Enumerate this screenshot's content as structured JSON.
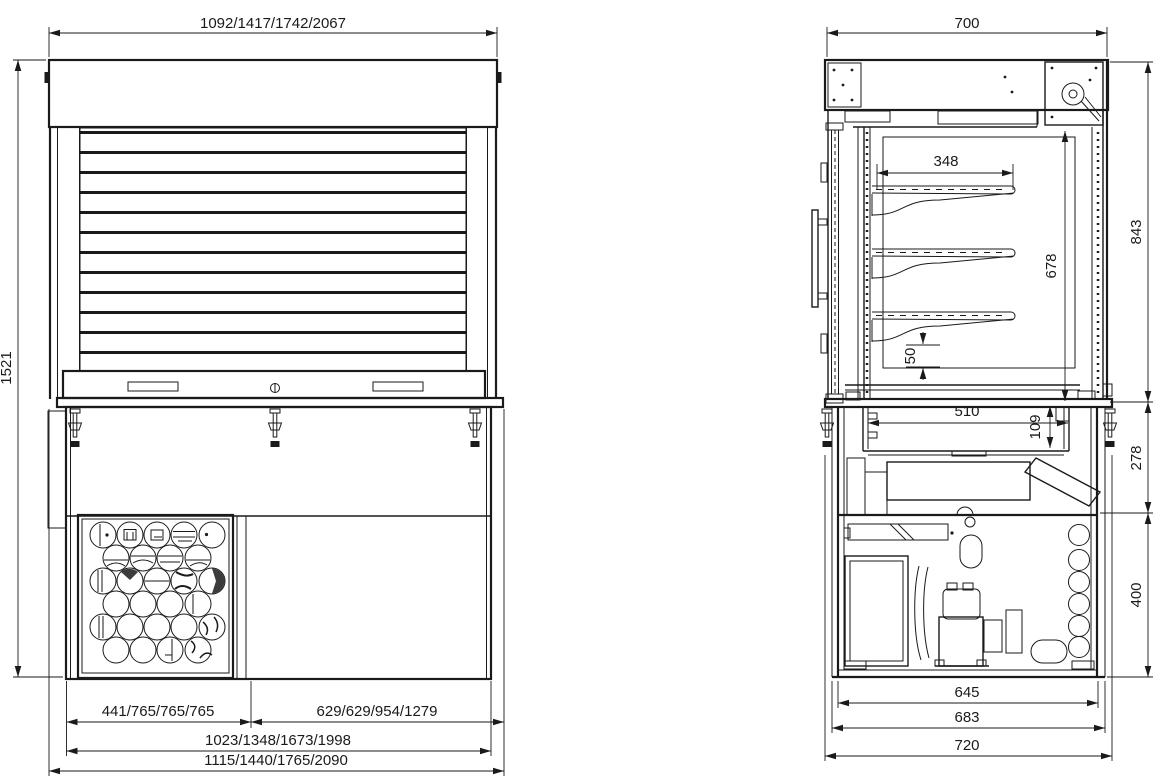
{
  "drawing_type": "technical dimension drawing, refrigerated display case with roller shutter",
  "line_color": "#1a1a1a",
  "background": "#ffffff",
  "front_view": {
    "name": "front elevation with roller shutter",
    "dims": {
      "overall_width_top": "1092/1417/1742/2067",
      "overall_height": "1521",
      "grille_width": "441/765/765/765",
      "right_section_width": "629/629/954/1279",
      "body_width": "1023/1348/1673/1998",
      "overall_width_bottom": "1115/1440/1765/2090"
    }
  },
  "side_view": {
    "name": "side section",
    "dims": {
      "overall_depth_top": "700",
      "shelf_depth": "348",
      "interior_height": "678",
      "display_height": "843",
      "well_section_height": "278",
      "base_section_height": "400",
      "well_width": "510",
      "well_depth": "109",
      "shelf_pitch": "50",
      "base_inner_depth": "645",
      "base_body_depth": "683",
      "overall_depth_bottom": "720"
    }
  }
}
